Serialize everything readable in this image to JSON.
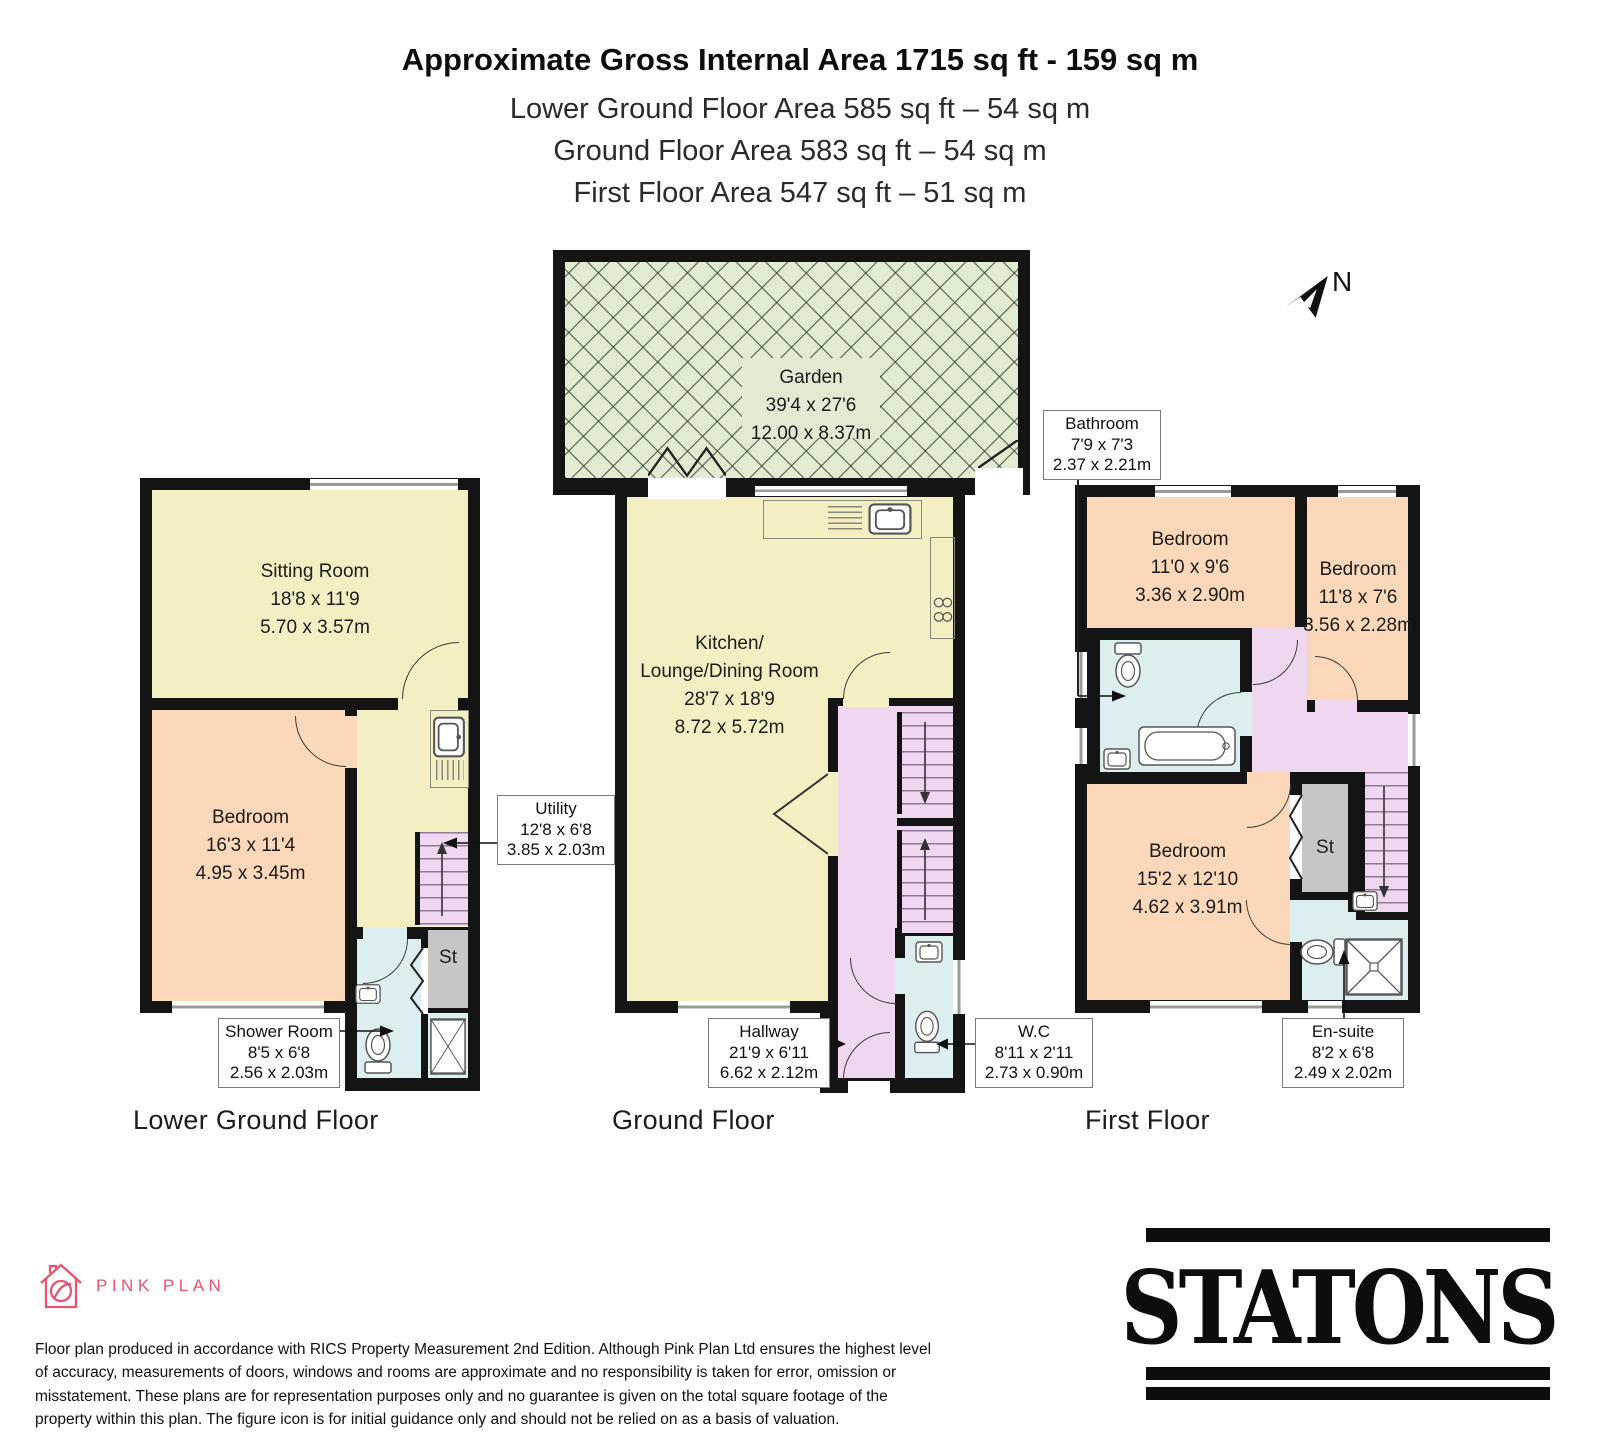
{
  "header": {
    "title": "Approximate Gross Internal Area 1715 sq ft - 159 sq m",
    "lines": [
      "Lower Ground Floor Area 585 sq ft – 54 sq m",
      "Ground Floor Area 583 sq ft – 54 sq m",
      "First Floor Area 547 sq ft – 51 sq m"
    ]
  },
  "compass": {
    "label": "N"
  },
  "floors": [
    {
      "name": "Lower Ground Floor",
      "rooms": [
        {
          "name": "Sitting Room",
          "imperial": "18'8 x 11'9",
          "metric": "5.70 x 3.57m"
        },
        {
          "name": "Bedroom",
          "imperial": "16'3 x 11'4",
          "metric": "4.95 x 3.45m"
        },
        {
          "name": "St"
        }
      ],
      "callouts": [
        {
          "name": "Utility",
          "imperial": "12'8 x 6'8",
          "metric": "3.85 x 2.03m"
        },
        {
          "name": "Shower Room",
          "imperial": "8'5 x 6'8",
          "metric": "2.56 x 2.03m"
        }
      ]
    },
    {
      "name": "Ground Floor",
      "rooms": [
        {
          "name": "Garden",
          "imperial": "39'4 x 27'6",
          "metric": "12.00 x 8.37m"
        },
        {
          "name": "Kitchen/",
          "name2": "Lounge/Dining Room",
          "imperial": "28'7 x 18'9",
          "metric": "8.72 x 5.72m"
        }
      ],
      "callouts": [
        {
          "name": "Hallway",
          "imperial": "21'9 x 6'11",
          "metric": "6.62 x 2.12m"
        },
        {
          "name": "W.C",
          "imperial": "8'11 x 2'11",
          "metric": "2.73 x 0.90m"
        }
      ]
    },
    {
      "name": "First Floor",
      "rooms": [
        {
          "name": "Bedroom",
          "imperial": "11'0 x 9'6",
          "metric": "3.36 x 2.90m"
        },
        {
          "name": "Bedroom",
          "imperial": "11'8 x 7'6",
          "metric": "3.56 x 2.28m"
        },
        {
          "name": "Bedroom",
          "imperial": "15'2 x 12'10",
          "metric": "4.62 x 3.91m"
        },
        {
          "name": "St"
        }
      ],
      "callouts": [
        {
          "name": "Bathroom",
          "imperial": "7'9 x 7'3",
          "metric": "2.37 x 2.21m"
        },
        {
          "name": "En-suite",
          "imperial": "8'2 x 6'8",
          "metric": "2.49 x 2.02m"
        }
      ]
    }
  ],
  "footer": {
    "brand": "PINK PLAN",
    "disclaimer": "Floor plan produced in accordance with RICS Property Measurement 2nd Edition. Although Pink Plan Ltd ensures the highest level of accuracy, measurements of doors, windows and rooms are approximate and no responsibility is taken for error, omission or misstatement. These plans are for representation purposes only and no guarantee is given on the total square footage of the property within this plan. The figure icon is for initial guidance only and should not be relied on as a basis of valuation.",
    "agency": "STATONS"
  },
  "colors": {
    "wall": "#141414",
    "room_cream": "#f4eec3",
    "room_peach": "#fbd8b9",
    "room_blue": "#dceef0",
    "room_purple": "#eed7ef",
    "garden_green": "#e0ebd2",
    "storage_gray": "#c6c5c7",
    "brand_pink": "#e8536e"
  }
}
